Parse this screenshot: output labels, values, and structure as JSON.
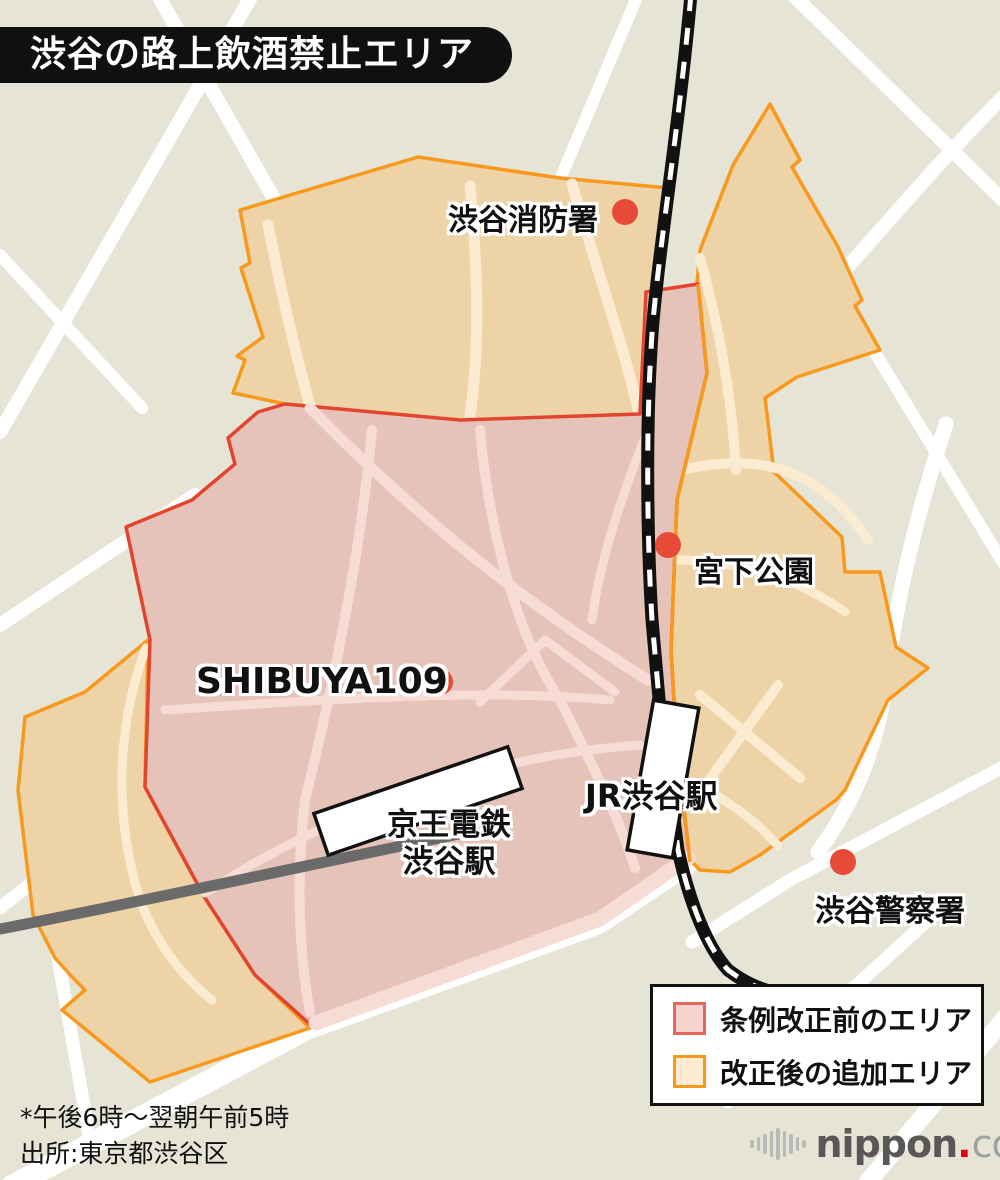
{
  "title": "渋谷の路上飲酒禁止エリア",
  "map": {
    "labels": {
      "fire_station": "渋谷消防署",
      "miyashita_park": "宮下公園",
      "shibuya109": "SHIBUYA109",
      "jr_station": "JR渋谷駅",
      "keio_station_line1": "京王電鉄",
      "keio_station_line2": "渋谷駅",
      "police_station": "渋谷警察署"
    },
    "markers": [
      {
        "name": "fire-station-dot",
        "x": 625,
        "y": 212
      },
      {
        "name": "miyashita-park-dot",
        "x": 668,
        "y": 545
      },
      {
        "name": "shibuya109-dot",
        "x": 440,
        "y": 682
      },
      {
        "name": "police-station-dot",
        "x": 843,
        "y": 862
      }
    ],
    "colors": {
      "background": "#e6e4d4",
      "road": "#ffffff",
      "area_before_fill": "#e6c3b8",
      "area_before_border": "#e2452f",
      "area_before_road": "#f6dcd4",
      "area_added_fill": "#eed3a7",
      "area_added_border": "#f8991d",
      "area_added_road": "#fbebd1",
      "marker_dot": "#e84a38",
      "railway_black": "#111111",
      "keio_line_gray": "#6a6a6a"
    }
  },
  "legend": {
    "items": [
      {
        "label": "条例改正前のエリア",
        "fill": "#f5d2cb",
        "border": "#e8655b"
      },
      {
        "label": "改正後の追加エリア",
        "fill": "#fdecd3",
        "border": "#f8991d"
      }
    ]
  },
  "footnotes": {
    "line1": "*午後6時〜翌朝午前5時",
    "line2": "出所:東京都渋谷区"
  },
  "logo": {
    "bold": "nippon",
    "dot": ".",
    "light": "com"
  }
}
